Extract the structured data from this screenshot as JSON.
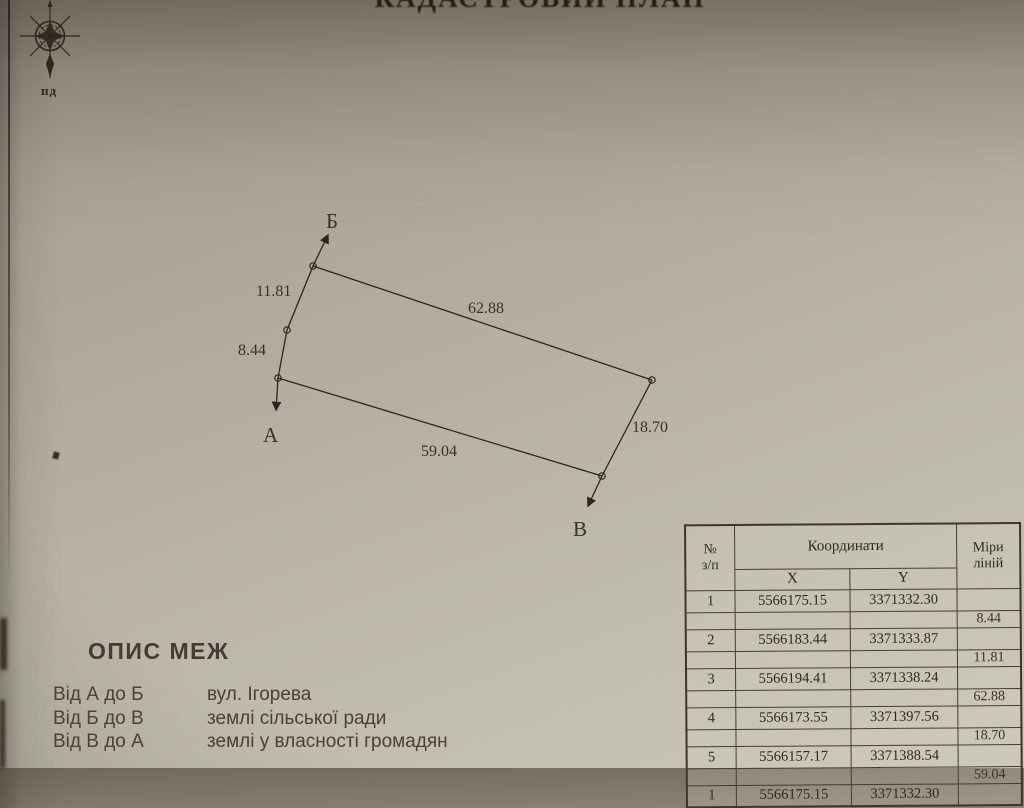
{
  "page": {
    "title_partial": "КАДАСТРОВИЙ ПЛАН"
  },
  "compass": {
    "south_label": "пд"
  },
  "diagram": {
    "points": {
      "a": "А",
      "b": "Б",
      "v": "В"
    },
    "edge_lengths": {
      "p1_p2": "8.44",
      "p2_p3": "11.81",
      "p3_p4": "62.88",
      "p4_p5": "18.70",
      "p5_p1": "59.04"
    }
  },
  "coords_table": {
    "header": {
      "num_line1": "№",
      "num_line2": "з/п",
      "coords": "Координати",
      "x": "X",
      "y": "Y",
      "measure_line1": "Міри",
      "measure_line2": "ліній"
    },
    "rows": [
      {
        "n": "1",
        "x": "5566175.15",
        "y": "3371332.30",
        "m": ""
      },
      {
        "n": "",
        "x": "",
        "y": "",
        "m": "8.44"
      },
      {
        "n": "2",
        "x": "5566183.44",
        "y": "3371333.87",
        "m": ""
      },
      {
        "n": "",
        "x": "",
        "y": "",
        "m": "11.81"
      },
      {
        "n": "3",
        "x": "5566194.41",
        "y": "3371338.24",
        "m": ""
      },
      {
        "n": "",
        "x": "",
        "y": "",
        "m": "62.88"
      },
      {
        "n": "4",
        "x": "5566173.55",
        "y": "3371397.56",
        "m": ""
      },
      {
        "n": "",
        "x": "",
        "y": "",
        "m": "18.70"
      },
      {
        "n": "5",
        "x": "5566157.17",
        "y": "3371388.54",
        "m": ""
      },
      {
        "n": "",
        "x": "",
        "y": "",
        "m": "59.04"
      },
      {
        "n": "1",
        "x": "5566175.15",
        "y": "3371332.30",
        "m": ""
      }
    ]
  },
  "boundaries": {
    "heading": "ОПИС МЕЖ",
    "items": [
      {
        "segment": "Від А до Б",
        "description": "вул. Ігорева"
      },
      {
        "segment": "Від Б до В",
        "description": "землі сільської ради"
      },
      {
        "segment": "Від В до А",
        "description": "землі у власності громадян"
      }
    ]
  },
  "colors": {
    "paper": "#b5b0a3",
    "ink": "#2c2620",
    "table_border": "#463d30"
  }
}
